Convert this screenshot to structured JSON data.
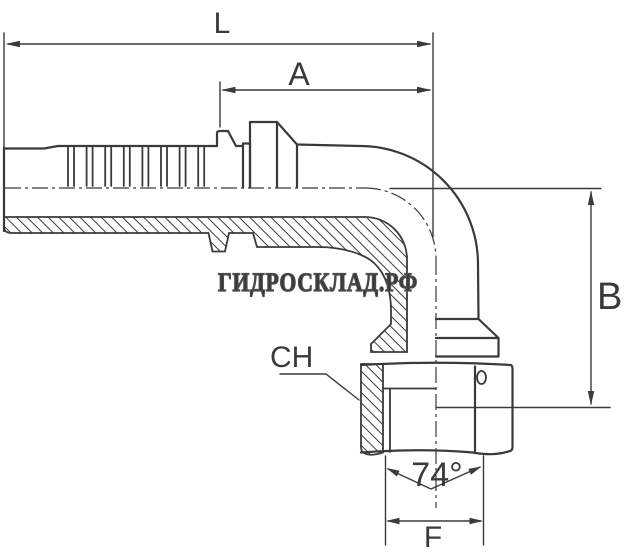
{
  "drawing": {
    "type": "technical-dimension-drawing",
    "subject": "90-degree elbow hose fitting, half-section view",
    "line_color": "#3a3a3a",
    "background_color": "#ffffff",
    "watermark": "ГИДРОСКЛАД.РФ",
    "labels": {
      "overall_length": "L",
      "tail_length": "A",
      "drop_height": "B",
      "wrench_size": "CH",
      "cone_angle": "74°",
      "nut_width": "F"
    }
  }
}
